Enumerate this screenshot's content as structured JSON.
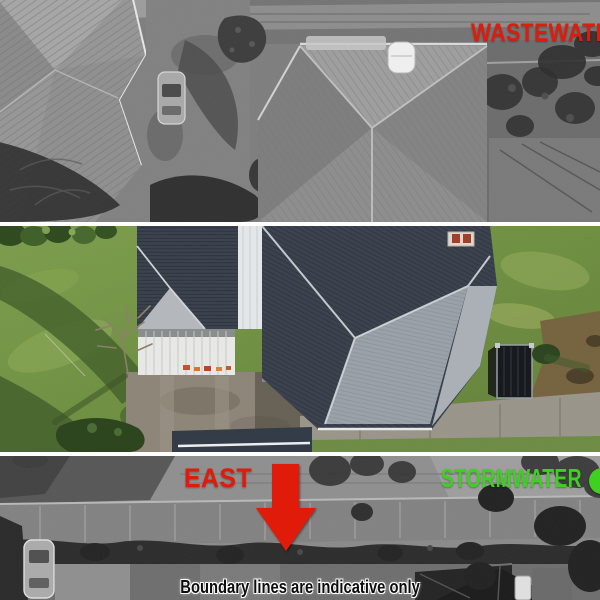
{
  "annotations": {
    "wastewater_label": "WASTEWATER",
    "east_label": "EAST",
    "stormwater_label": "STORMWATER",
    "boundary_note": "Boundary lines are indicative only",
    "colors": {
      "utility_red": "#e11b0a",
      "utility_green": "#3ed11f",
      "note_text": "#0d0d0d"
    },
    "icons": {
      "east_arrow": "down-arrow-icon",
      "stormwater_marker": "green-dot-icon"
    }
  }
}
